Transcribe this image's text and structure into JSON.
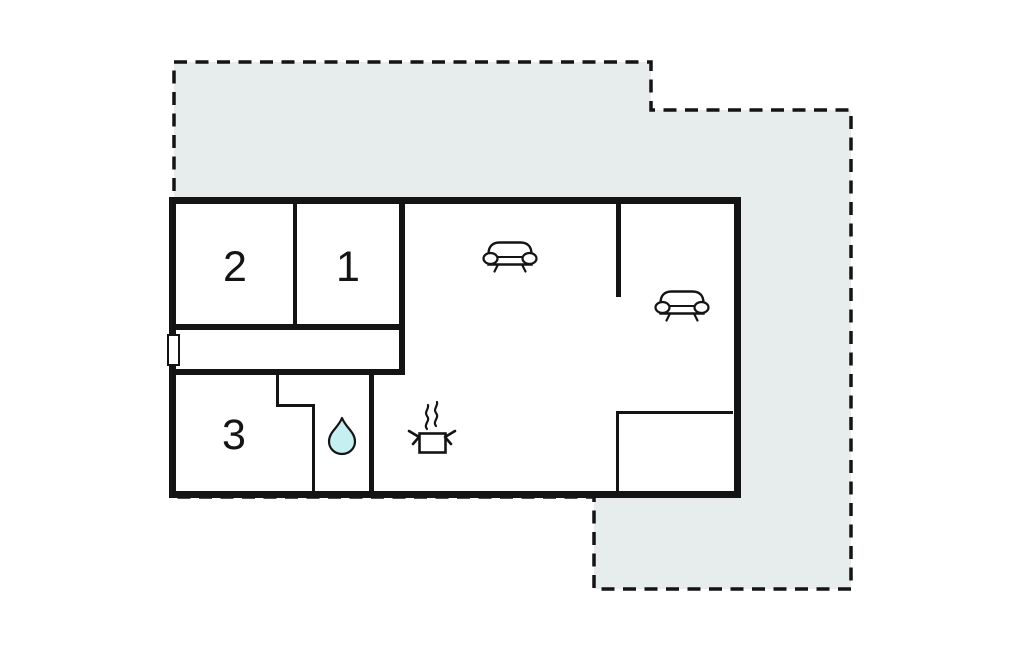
{
  "floor_plan": {
    "type": "holiday-home-floor-plan",
    "room_labels": {
      "room1": "1",
      "room2": "2",
      "room3": "3"
    },
    "colors": {
      "wall": "#141414",
      "terrace_fill": "#e7edec",
      "terrace_outline": "#141414",
      "water_drop_fill": "#c6eff2",
      "background": "#ffffff"
    },
    "icons": [
      "sofa-icon",
      "sofa-icon",
      "water-drop-icon",
      "cooking-pot-icon",
      "steam-icon",
      "door-window-marker"
    ]
  }
}
